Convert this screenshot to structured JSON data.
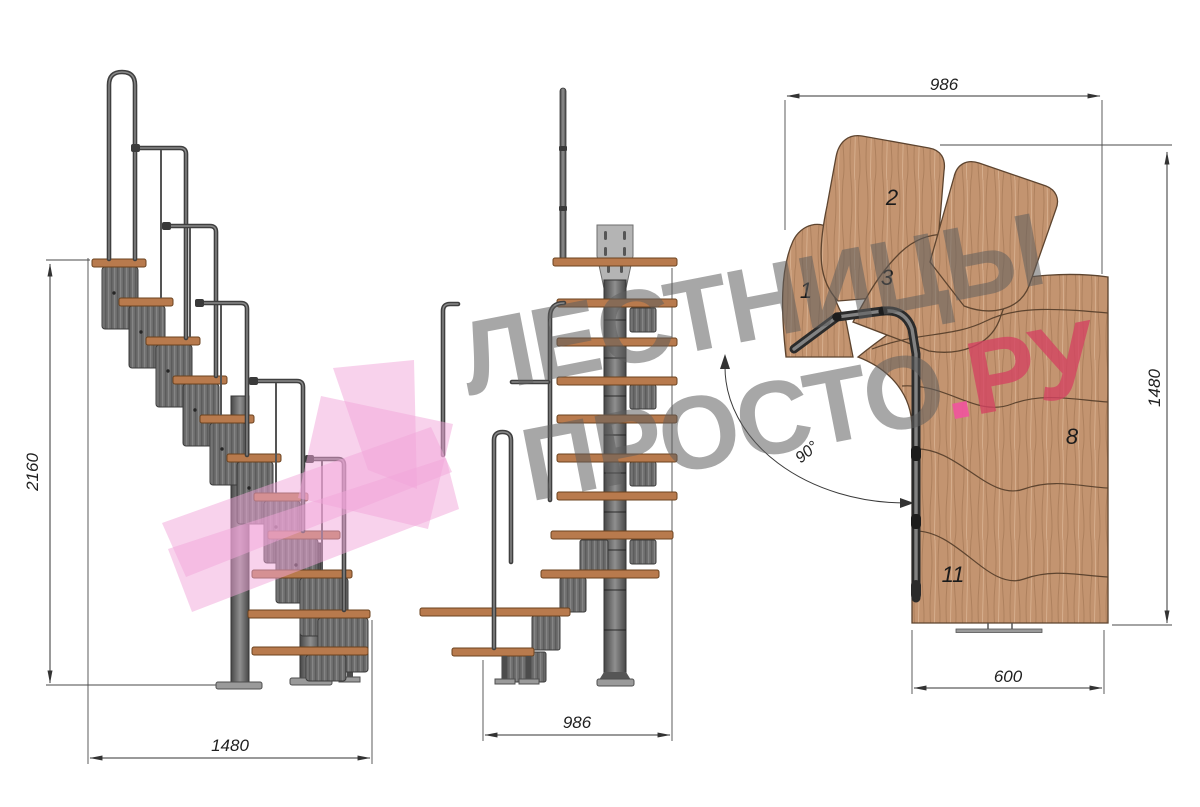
{
  "watermark": {
    "line1": "ЛЕСТНИЦЫ",
    "line2_word": "ПРОСТО",
    "dot": ".",
    "tld": "РУ"
  },
  "views": {
    "side": {
      "height": "2160",
      "width": "1480"
    },
    "front": {
      "width": "986"
    },
    "plan": {
      "width": "986",
      "depth": "1480",
      "step_width": "600",
      "angle": "90°",
      "steps": [
        "1",
        "2",
        "3",
        "8",
        "11"
      ]
    }
  },
  "colors": {
    "wood": "#c39470",
    "tread": "#b87a4d",
    "metal": "#6e6e6e",
    "metal_dark": "#3b3b3b",
    "watermark_gray": "#9e9e9e",
    "watermark_pink": "#f2a6d9",
    "brand_dot_pink": "#f0559c",
    "brand_red": "#d34362",
    "dimension_line": "#333333"
  }
}
